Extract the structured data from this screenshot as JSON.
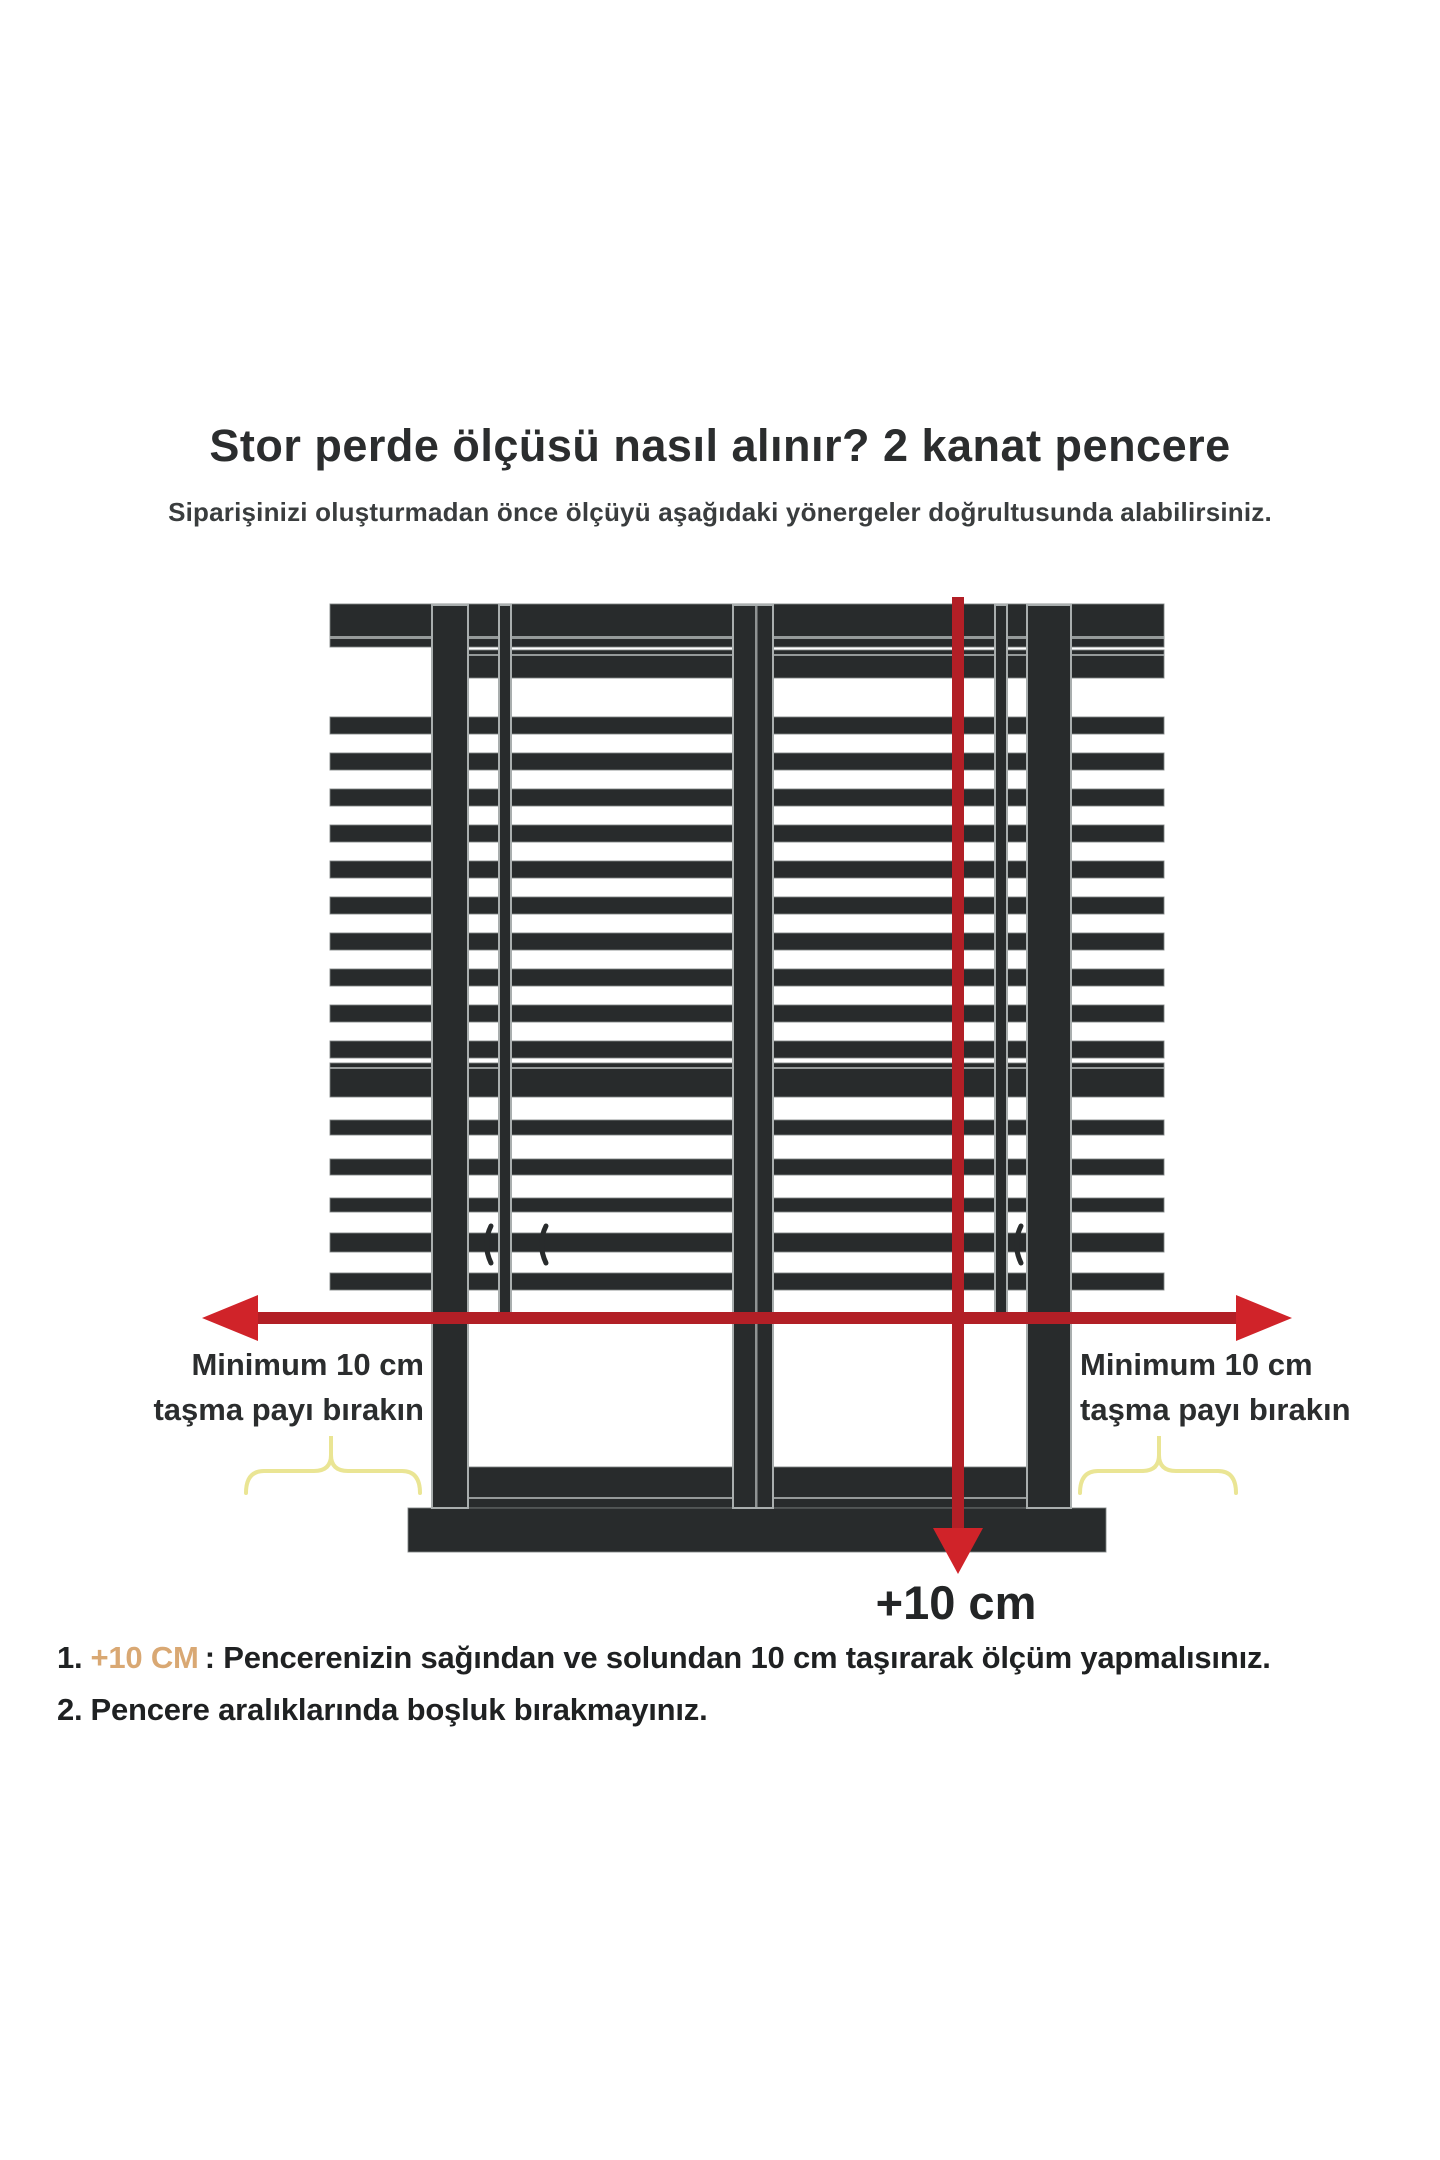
{
  "header": {
    "title": "Stor perde ölçüsü nasıl alınır? 2 kanat pencere",
    "subtitle": "Siparişinizi oluşturmadan önce ölçüyü aşağıdaki yönergeler doğrultusunda alabilirsiniz."
  },
  "diagram": {
    "left_label": {
      "line1": "Minimum 10 cm",
      "line2": "taşma payı bırakın"
    },
    "right_label": {
      "line1": "Minimum 10 cm",
      "line2": "taşma payı bırakın"
    },
    "vertical_arrow_label": "+10 cm",
    "colors": {
      "frame_dark": "#282b2c",
      "edge_light": "#a9aeae",
      "arrow_shaft_red": "#b21f26",
      "arrow_head_red": "#d02329",
      "brace_yellow": "#eae594",
      "highlight_tan": "#d9a873",
      "text_dark": "#2b2d2e",
      "background": "#ffffff"
    }
  },
  "instructions": [
    {
      "number": "1.",
      "highlight": "+10 CM",
      "rest": ": Pencerenizin sağından ve solundan 10 cm taşırarak ölçüm yapmalısınız."
    },
    {
      "number": "2.",
      "highlight": "",
      "rest": "Pencere aralıklarında boşluk bırakmayınız."
    }
  ]
}
